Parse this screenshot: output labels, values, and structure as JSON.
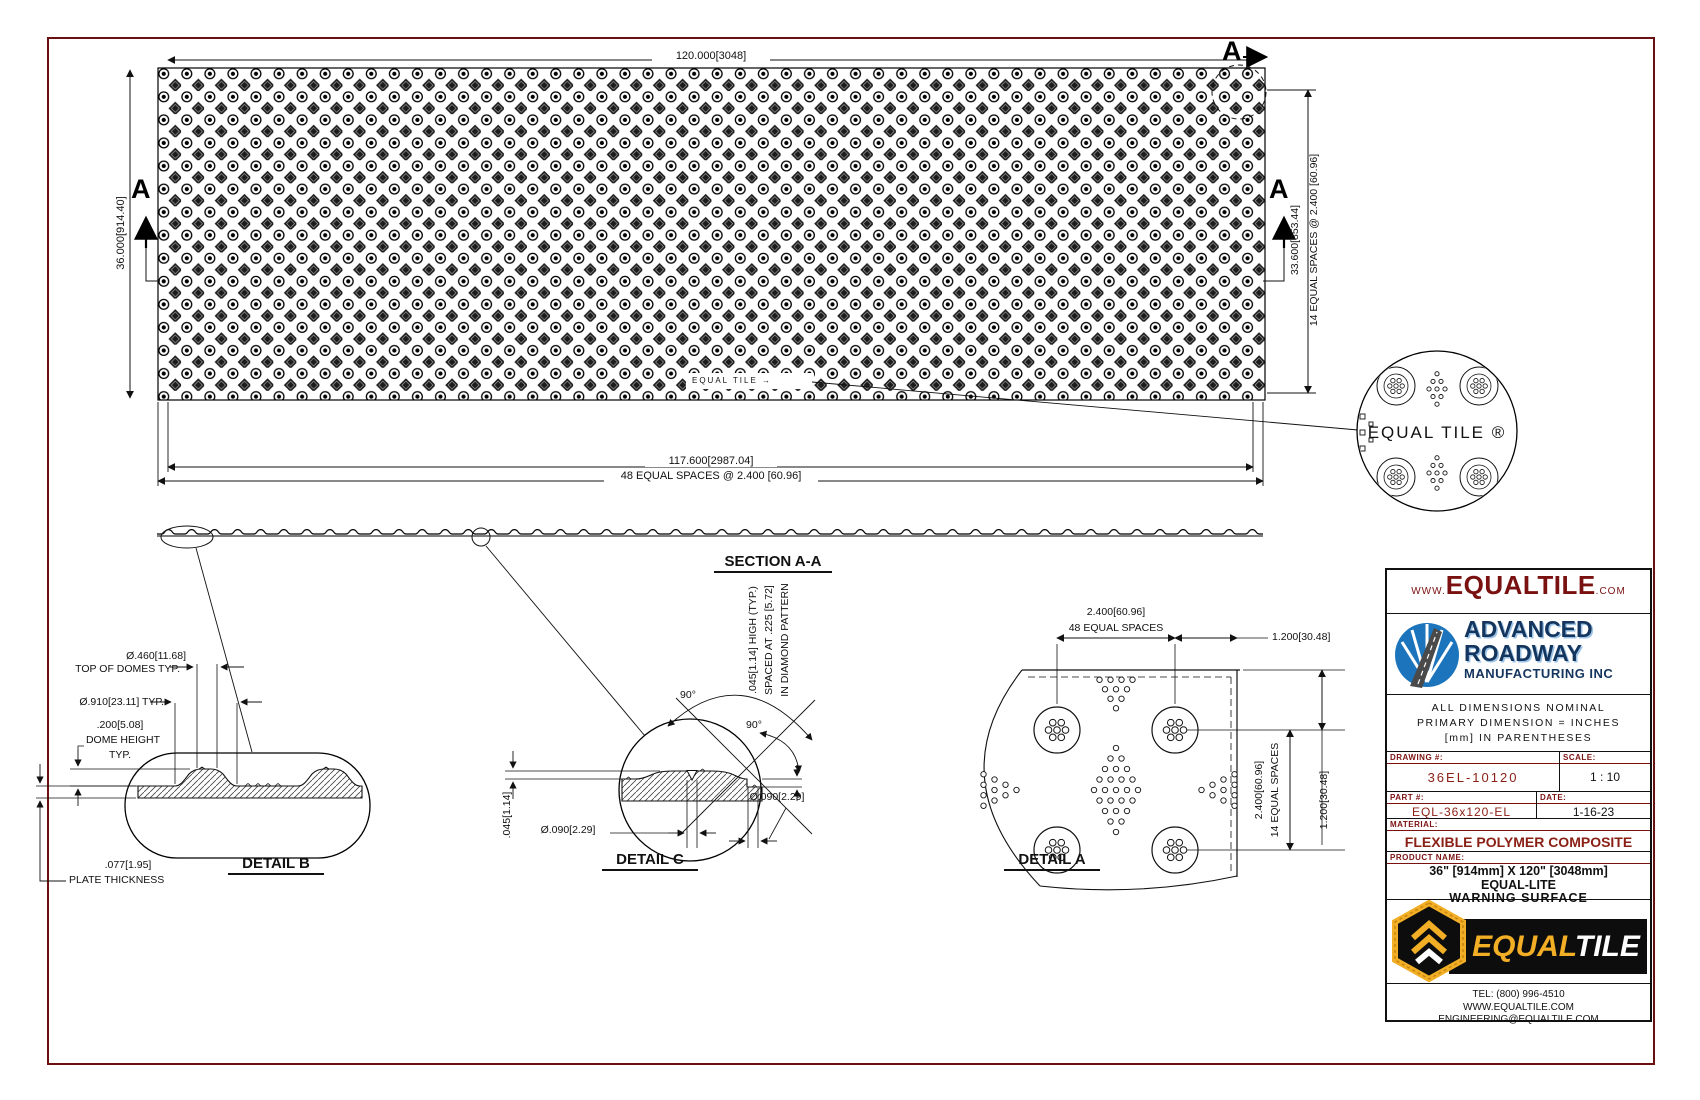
{
  "plan": {
    "top_dim": "120.000[3048]",
    "left_dim": "36.000[914.40]",
    "right_dim_1": "33.600[853.44]",
    "right_dim_2": "14 EQUAL SPACES @ 2.400 [60.96]",
    "bottom_dim_1": "117.600[2987.04]",
    "bottom_dim_2": "48 EQUAL SPACES @ 2.400 [60.96]",
    "section_marker": "A",
    "embossed_text": "EQUAL TILE →",
    "balloon_text": "EQUAL TILE ®"
  },
  "section": {
    "label": "SECTION A-A"
  },
  "detail_b": {
    "label": "DETAIL B",
    "dome_top_dia": "Ø.460[11.68]",
    "dome_top_note": "TOP OF DOMES TYP.",
    "dome_base_dia": "Ø.910[23.11] TYP.",
    "dome_height": ".200[5.08]",
    "dome_height_note1": "DOME HEIGHT",
    "dome_height_note2": "TYP.",
    "plate_dim": ".077[1.95]",
    "plate_note": "PLATE THICKNESS"
  },
  "detail_c": {
    "label": "DETAIL C",
    "angle_1": "90°",
    "angle_2": "90°",
    "height_dim": ".045[1.14]",
    "groove_dim_1": "Ø.090[2.29]",
    "groove_dim_2": "Ø.090[2.29]",
    "note_line_1": ".045[1.14] HIGH (TYP.)",
    "note_line_2": "SPACED AT .225 [5.72]",
    "note_line_3": "IN DIAMOND PATTERN"
  },
  "detail_a": {
    "label": "DETAIL A",
    "top_dim_1": "2.400[60.96]",
    "top_dim_2": "48 EQUAL SPACES",
    "top_right_dim": "1.200[30.48]",
    "right_dim_1": "2.400[60.96]",
    "right_dim_2": "14 EQUAL SPACES",
    "right_dim_3": "1.200[30.48]"
  },
  "title_block": {
    "website": {
      "prefix": "WWW.",
      "name": "EQUALTILE",
      "suffix": ".COM"
    },
    "company": {
      "line1": "ADVANCED",
      "line2": "ROADWAY",
      "line3": "MANUFACTURING INC"
    },
    "notes": [
      "ALL DIMENSIONS NOMINAL",
      "PRIMARY DIMENSION = INCHES",
      "[mm] IN PARENTHESES"
    ],
    "drawing_no": {
      "label": "DRAWING #:",
      "value": "36EL-10120"
    },
    "scale": {
      "label": "SCALE:",
      "value": "1 : 10"
    },
    "part_no": {
      "label": "PART #:",
      "value": "EQL-36x120-EL"
    },
    "date": {
      "label": "DATE:",
      "value": "1-16-23"
    },
    "material": {
      "label": "MATERIAL:",
      "value": "FLEXIBLE POLYMER COMPOSITE"
    },
    "product": {
      "label": "PRODUCT NAME:",
      "line1": "36\" [914mm] X 120\" [3048mm]",
      "line2": "EQUAL-LITE",
      "line3": "WARNING SURFACE"
    },
    "logo": {
      "gold": "EQUAL",
      "white": "TILE"
    },
    "contact": [
      "TEL: (800) 996-4510",
      "WWW.EQUALTILE.COM",
      "ENGINEERING@EQUALTILE.COM"
    ]
  },
  "colors": {
    "maroon": "#7a1111",
    "navy": "#14355e",
    "blue": "#1c75bc",
    "gold": "#f2ae24",
    "line": "#111111"
  }
}
